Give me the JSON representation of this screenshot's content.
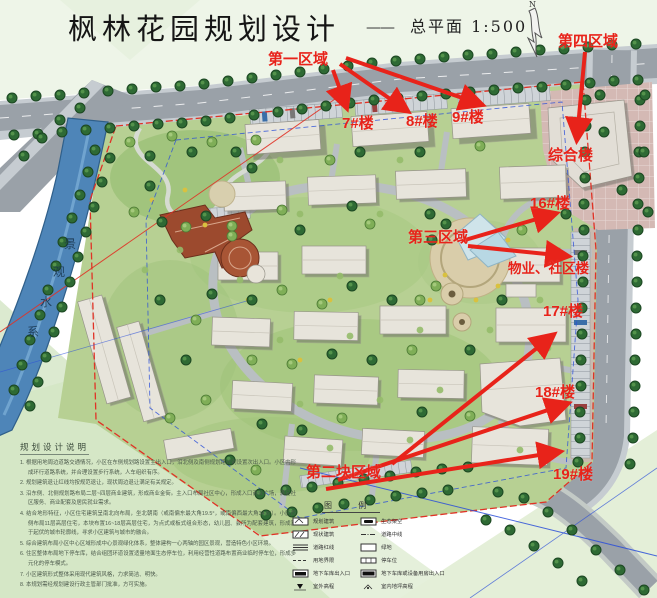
{
  "title": {
    "main": "枫林花园规划设计",
    "dash": "——",
    "subtitle": "总平面  1:500"
  },
  "north_label": "N",
  "water_label_chars": [
    "景",
    "观",
    "水",
    "系"
  ],
  "annotations": {
    "area1": "第一区域",
    "area4": "第四区域",
    "area3": "第三区域",
    "area2": "第二块区域",
    "b7": "7#楼",
    "b8": "8#楼",
    "b9": "9#楼",
    "complex": "综合楼",
    "b16": "16#楼",
    "community": "物业、社区楼",
    "b17": "17#楼",
    "b18": "18#楼",
    "b19": "19#楼"
  },
  "notes": {
    "title": "规划设计说明",
    "items": [
      "1. 根据用地周边道路交通情况，小区在东侧规划路设置主出入口，沿北侧及南侧规划路分别设置次出入口。小区内形成环行道路系统，并合理设置步行系统，人车组织有序。",
      "2. 规划建筑退让红线均按规范退让，现状周边退让满足有关规定。",
      "3. 沿东侧、北侧规划路布局二层~四层商业建筑，形成商业金街。主入口布局社区中心，形成入口商业广场，满足社区服务、商业配套及居民就业需求。",
      "4. 结合地形特征，小区住宅建筑呈南北向布局，坐北朝南（或南偏东最大角19.5°，或南偏西最大角34.6°）。小区西侧布局11层高层住宅，本块布置16~18层高层住宅，为点式或板式组合形态，幼儿园、会所为配套建筑，形成富于起伏的城市轮廓线，寻求小区建筑与城市的融合。",
      "5. 综合建筑布局小区中心区域形成中心景观绿化体系，整体建构一心两轴的园区景观，营造特色小区环境。",
      "6. 住区整体布局地下停车库，结合组团环道设置适量地面生态停车位，利用经营性道路布置商业临时停车位，形成多元化的停车模式。",
      "7. 小区建筑形式整体采用现代建筑风格，力求简洁、明快。",
      "8. 本规划需经规划建设行政主管部门批准，方可实施。"
    ]
  },
  "legend": {
    "title": "图 例",
    "left": [
      {
        "icon": "planned-building-icon",
        "label": "规划建筑"
      },
      {
        "icon": "existing-building-icon",
        "label": "现状建筑"
      },
      {
        "icon": "road-redline-icon",
        "label": "道路红线"
      },
      {
        "icon": "site-boundary-icon",
        "label": "用地界限"
      },
      {
        "icon": "garage-entrance-icon",
        "label": "地下车库出入口"
      },
      {
        "icon": "outdoor-elevation-icon",
        "label": "室外高程"
      }
    ],
    "right": [
      {
        "icon": "eco-deck-icon",
        "label": "生态架空"
      },
      {
        "icon": "road-centerline-icon",
        "label": "道路中线"
      },
      {
        "icon": "greenspace-icon",
        "label": "绿地"
      },
      {
        "icon": "parking-icon",
        "label": "停车位"
      },
      {
        "icon": "garage-equipment-entrance-icon",
        "label": "地下车库或设备用房出入口"
      },
      {
        "icon": "indoor-elevation-icon",
        "label": "室内地坪高程"
      }
    ]
  },
  "colors": {
    "annotation_red": "#e8231a",
    "boundary_red": "#e03226",
    "setback_blue": "#2b4fd8",
    "road_gray": "#9aa1a8",
    "water_blue": "#4e85b8",
    "site_green": "#b7d093"
  }
}
